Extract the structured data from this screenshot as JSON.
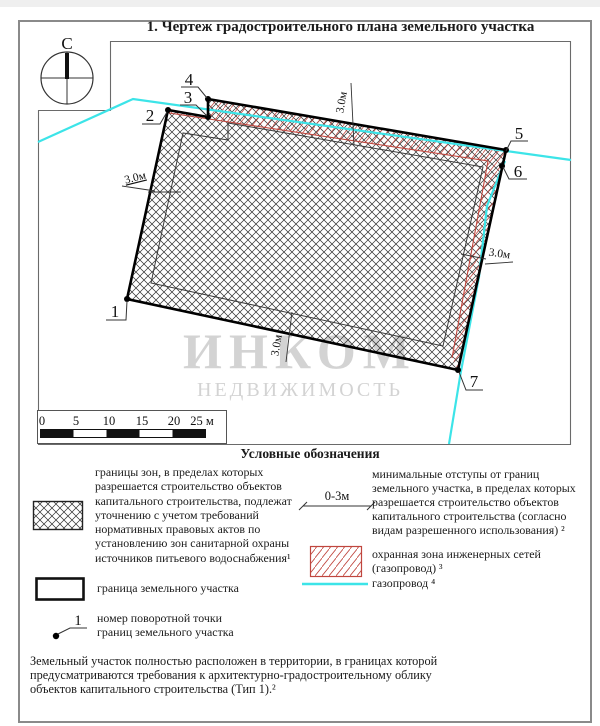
{
  "document": {
    "title": "1. Чертеж градостроительного плана земельного участка",
    "compass_north": "С"
  },
  "map": {
    "vertex_labels": [
      "1",
      "2",
      "3",
      "4",
      "5",
      "6",
      "7"
    ],
    "offset_dim_labels": [
      "3.0м",
      "3.0м",
      "3.0м",
      "3.0м"
    ],
    "scale_ticks": [
      "0",
      "5",
      "10",
      "15",
      "20",
      "25 м"
    ],
    "watermark_line1": "ИНКОМ",
    "watermark_line2": "НЕДВИЖИМОСТЬ"
  },
  "legend": {
    "title": "Условные обозначения",
    "left": [
      {
        "text": "границы зон, в пределах которых\nразрешается строительство объектов\nкапитального строительства, подлежат\nуточнению с учетом требований\nнормативных правовых актов по\nустановлению зон санитарной охраны\nисточников питьевого водоснабжения¹"
      },
      {
        "text": "граница земельного участка"
      },
      {
        "symbol_label": "1",
        "text": "номер поворотной точки\nграниц земельного участка"
      }
    ],
    "right": [
      {
        "symbol_label": "0-3м",
        "text": "минимальные отступы от границ\nземельного участка, в пределах которых\nразрешается строительство объектов\nкапитального строительства (согласно\nвидам разрешенного использования) ²"
      },
      {
        "text": "охранная зона инженерных сетей\n(газопровод) ³"
      },
      {
        "text": "газопровод ⁴"
      }
    ]
  },
  "footnote": "Земельный участок полностью расположен в территории, в границах которой\nпредусматриваются требования к архитектурно-градостроительному облику\nобъектов капитального строительства (Тип 1).²",
  "colors": {
    "pipeline": "#3ce4e8",
    "protection_zone": "#c0463e",
    "hatch": "#2e2e2e",
    "parcel_outline": "#000000",
    "frame": "#6a6a6a",
    "page_border": "#8a8a8a",
    "watermark": "#c9c9c9"
  }
}
